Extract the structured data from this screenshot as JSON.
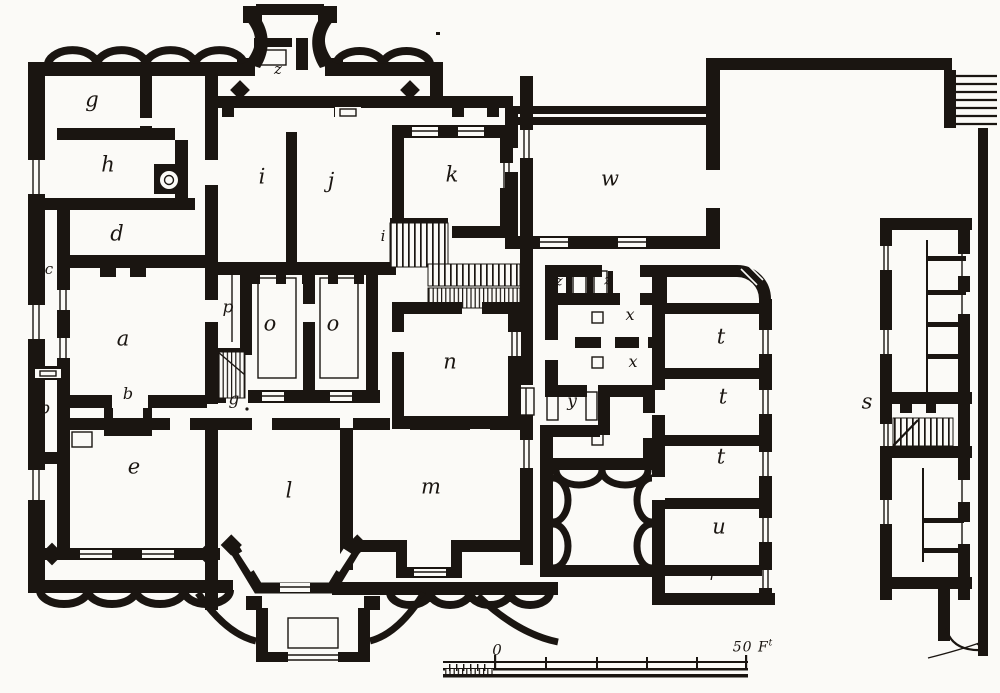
{
  "figure": {
    "type": "floor-plan",
    "description": "Scanned engraving: ground-floor plan of a country house with entrance porch, central light courts, service courtyard wing and detached stable range, with lettered rooms",
    "ink_color": "#1a1511",
    "paper_color": "#fbfaf7"
  },
  "room_labels": [
    {
      "label": "z",
      "x": 278,
      "y": 70,
      "size": 15
    },
    {
      "label": "g",
      "x": 92,
      "y": 101
    },
    {
      "label": "h",
      "x": 108,
      "y": 166
    },
    {
      "label": "d",
      "x": 117,
      "y": 235
    },
    {
      "label": "c",
      "x": 49,
      "y": 270,
      "size": 15
    },
    {
      "label": "a",
      "x": 123,
      "y": 340
    },
    {
      "label": "b",
      "x": 128,
      "y": 395,
      "size": 16
    },
    {
      "label": "b",
      "x": 45,
      "y": 410,
      "size": 17
    },
    {
      "label": "e",
      "x": 134,
      "y": 468
    },
    {
      "label": "i",
      "x": 262,
      "y": 178
    },
    {
      "label": "j",
      "x": 331,
      "y": 182
    },
    {
      "label": "p",
      "x": 228,
      "y": 309,
      "size": 17
    },
    {
      "label": "o",
      "x": 270,
      "y": 325
    },
    {
      "label": "o",
      "x": 333,
      "y": 325
    },
    {
      "label": "g",
      "x": 234,
      "y": 401,
      "size": 17
    },
    {
      "label": "k",
      "x": 452,
      "y": 176
    },
    {
      "label": "i",
      "x": 383,
      "y": 237,
      "size": 15
    },
    {
      "label": "n",
      "x": 450,
      "y": 363
    },
    {
      "label": "l",
      "x": 289,
      "y": 492
    },
    {
      "label": "m",
      "x": 431,
      "y": 488
    },
    {
      "label": "w",
      "x": 610,
      "y": 180
    },
    {
      "label": "z",
      "x": 559,
      "y": 282,
      "size": 14
    },
    {
      "label": "z",
      "x": 608,
      "y": 281,
      "size": 14
    },
    {
      "label": "x",
      "x": 630,
      "y": 316,
      "size": 16
    },
    {
      "label": "x",
      "x": 633,
      "y": 363,
      "size": 16
    },
    {
      "label": "y",
      "x": 572,
      "y": 403,
      "size": 17
    },
    {
      "label": "t",
      "x": 721,
      "y": 338
    },
    {
      "label": "t",
      "x": 723,
      "y": 398
    },
    {
      "label": "t",
      "x": 721,
      "y": 458
    },
    {
      "label": "u",
      "x": 719,
      "y": 528
    },
    {
      "label": "r",
      "x": 713,
      "y": 576,
      "size": 15
    },
    {
      "label": "s",
      "x": 867,
      "y": 403
    }
  ],
  "scale_bar": {
    "zero_label": "0",
    "end_label": "50 F",
    "end_sup": "t"
  }
}
